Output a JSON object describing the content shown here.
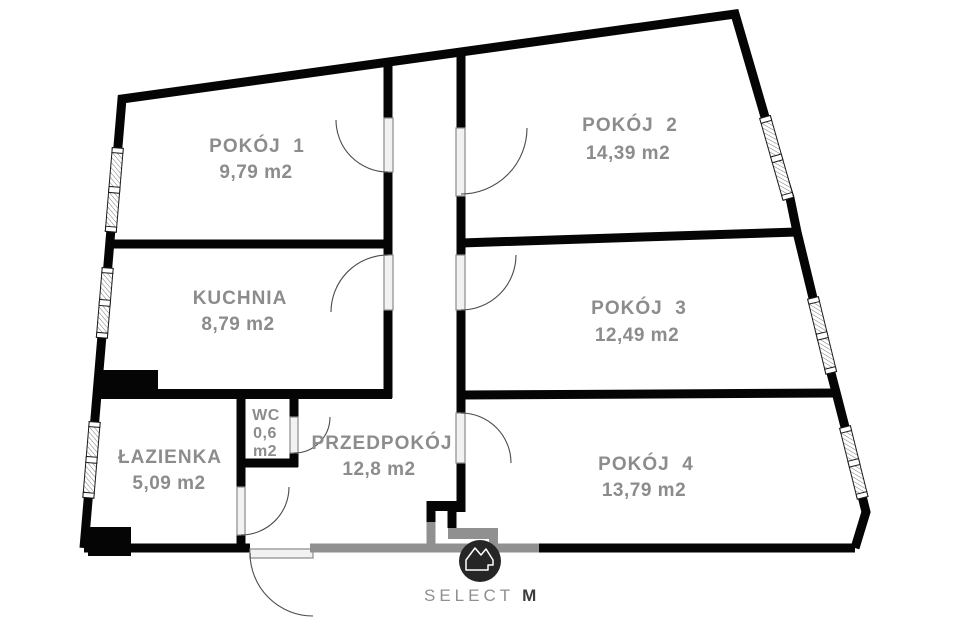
{
  "rooms": {
    "pokoj1": {
      "name": "POKÓJ  1",
      "area": "9,79 m2"
    },
    "pokoj2": {
      "name": "POKÓJ  2",
      "area": "14,39 m2"
    },
    "kuchnia": {
      "name": "KUCHNIA",
      "area": "8,79 m2"
    },
    "pokoj3": {
      "name": "POKÓJ  3",
      "area": "12,49 m2"
    },
    "lazienka": {
      "name": "ŁAZIENKA",
      "area": "5,09 m2"
    },
    "wc": {
      "name": "WC",
      "area_value": "0,6",
      "area_unit": "m2"
    },
    "przedpokoj": {
      "name": "PRZEDPOKÓJ",
      "area": "12,8 m2"
    },
    "pokoj4": {
      "name": "POKÓJ  4",
      "area": "13,79 m2"
    }
  },
  "branding": {
    "logo_text": "SELECT",
    "logo_suffix": "M"
  },
  "colors": {
    "wall": "#050505",
    "label": "#8c8c8c",
    "watermark": "#909090",
    "logo_circle": "#262626"
  }
}
